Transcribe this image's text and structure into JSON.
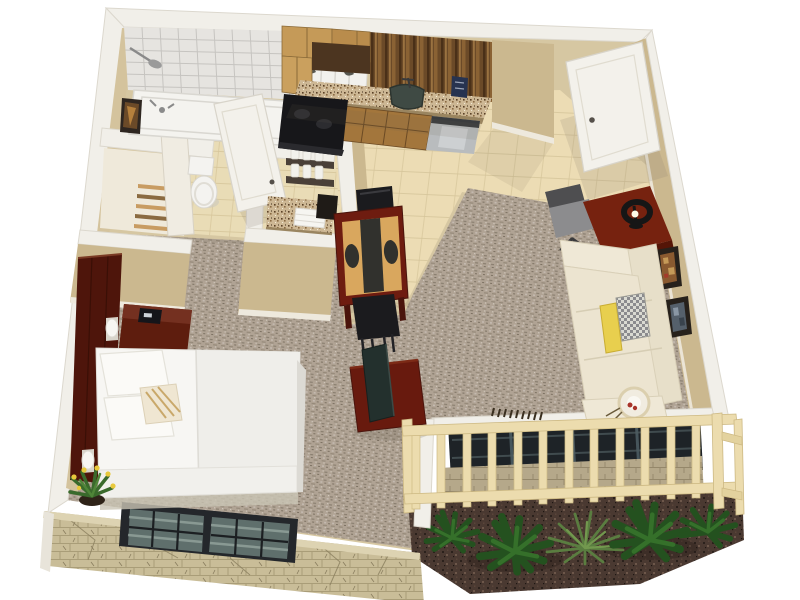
{
  "meta": {
    "title": "3D isometric studio apartment floor plan render",
    "view": "cutaway top-down perspective",
    "visible_text": ""
  },
  "palette": {
    "bg": "#ffffff",
    "wall_white": "#f1efe9",
    "wall_edge": "#dcd8ce",
    "wall_tan": "#cbb88f",
    "wall_tan_light": "#d4c39d",
    "baseboard": "#eee9dd",
    "carpet_base": "#b0a394",
    "tile": "#ecdcb4",
    "tile_line": "#d5c49a",
    "bath_tile": "#e9dcb6",
    "shower_tile": "#e6e4e0",
    "shower_line": "#c6c4c0",
    "tub_white": "#f4f3ef",
    "curtain_white": "#f2f1ed",
    "curtain_print": "#3c3c34",
    "toilet_white": "#f4f3f0",
    "door_white": "#f3f1eb",
    "stone_base": "#c9bd98",
    "stone_line": "#a08f68",
    "stone_top": "#ddd3b2",
    "window_frame": "#24272b",
    "window_glass": "#5f6f6c",
    "glass_streak": "#93a49e",
    "slider_glass": "#1e2327",
    "slider_streak": "#46555b",
    "fence_wood": "#ecdcae",
    "fence_shadow": "#cdb983",
    "mulch_base": "#4a3931",
    "plant_dark": "#24511f",
    "plant_mid": "#35702a",
    "plant_light": "#5a7d40",
    "cabinet_light": "#c59a58",
    "cabinet_mid": "#b98c4c",
    "hood_brown": "#4c3520",
    "backsplash_dark": "#6b4a28",
    "granite_base": "#cdb794",
    "granite_dark": "#5a4026",
    "sink_basin": "#3f4a44",
    "stove_black": "#17171a",
    "dishwasher_steel": "#b9bcbe",
    "appliance_blue": "#273350",
    "mahogany": "#6e1c10",
    "mahogany_dark": "#4a140c",
    "mat_tan": "#d9a75e",
    "mat_dark": "#31312d",
    "chair_black": "#1b1b1e",
    "desk_red": "#76220f",
    "lamp_black": "#161616",
    "bulb_glow": "#fffbe8",
    "office_chair_seat": "#8c8c8e",
    "office_chair_back": "#4e4e50",
    "frame_dark": "#27211b",
    "art_amber": "#8a5a30",
    "art_amber_light": "#c59a58",
    "art_slate": "#55606b",
    "sofa_cream": "#ece4d0",
    "sofa_cream_light": "#efe8d6",
    "sofa_cream_dark": "#e7dfc9",
    "sofa_seam": "#d6cdb4",
    "pillow_yellow": "#e8cf4e",
    "pillow_checker_light": "#dadad2",
    "pillow_checker_dark": "#8b8b8e",
    "fan_ring": "#f1ece0",
    "berry_red": "#a8342a",
    "bed_white": "#f7f6f3",
    "bed_shade": "#efeeea",
    "bed_shadow": "#c9c4b4",
    "pillow_white": "#fbfaf7",
    "pillow_stripe": "#c9a86a",
    "headboard_red": "#4e150b",
    "nightstand_red": "#5e1d0e",
    "nightstand_top": "#743020",
    "clock_black": "#15151a",
    "sconce_white": "#f7f6f2",
    "flower_yellow": "#e8c93c",
    "pot_brown": "#2e2318",
    "tv_dark": "#23302d",
    "tv_stand_red": "#681a0e",
    "shadow": "#6b6050",
    "shelf_dark": "#4a4038",
    "shelf_wood": "#c89c62",
    "towel_white": "#f6f5f1",
    "jar_white": "#f2f1ec"
  },
  "rooms": {
    "bathroom": {
      "label": "bathroom",
      "furniture": [
        "bathtub-shower",
        "shower-curtain",
        "shower-head",
        "toilet",
        "wall-art",
        "bathroom-door"
      ]
    },
    "closet": {
      "label": "closet",
      "furniture": [
        "wire-shelving",
        "closet-panel"
      ]
    },
    "vanity_nook": {
      "label": "vanity-nook",
      "furniture": [
        "granite-counter",
        "towel-stack",
        "jar-shelves",
        "mirror-panel"
      ]
    },
    "kitchen": {
      "label": "kitchenette",
      "furniture": [
        "upper-cabinets",
        "range-hood-panel",
        "wood-backsplash",
        "granite-countertop",
        "sink",
        "faucet",
        "stove",
        "base-cabinets",
        "dishwasher",
        "wall-appliance"
      ]
    },
    "entry": {
      "label": "entry",
      "furniture": [
        "entry-door"
      ]
    },
    "dining_area": {
      "label": "dining-area",
      "furniture": [
        "dining-table",
        "placemats",
        "dining-chair-north",
        "dining-chair-south"
      ]
    },
    "living_area": {
      "label": "living-area",
      "furniture": [
        "desk",
        "desk-lamp",
        "office-chair",
        "wall-picture-1",
        "wall-picture-2",
        "sectional-sofa",
        "yellow-bolster-pillow",
        "pattern-pillow",
        "round-fan-decor"
      ]
    },
    "sleeping_area": {
      "label": "sleeping-area",
      "furniture": [
        "headboard-panel",
        "nightstand",
        "alarm-clock",
        "wall-sconce-1",
        "wall-sconce-2",
        "double-bed",
        "bed-pillows",
        "accent-pillow",
        "floor-plant",
        "tv-stand",
        "television"
      ]
    },
    "balcony": {
      "label": "balcony",
      "furniture": [
        "sliding-glass-door",
        "stone-knee-wall",
        "wood-railing",
        "planter-mulch-bed",
        "tropical-plants"
      ]
    },
    "exterior": {
      "label": "exterior",
      "furniture": [
        "stone-facade-wall",
        "grid-window"
      ]
    }
  }
}
